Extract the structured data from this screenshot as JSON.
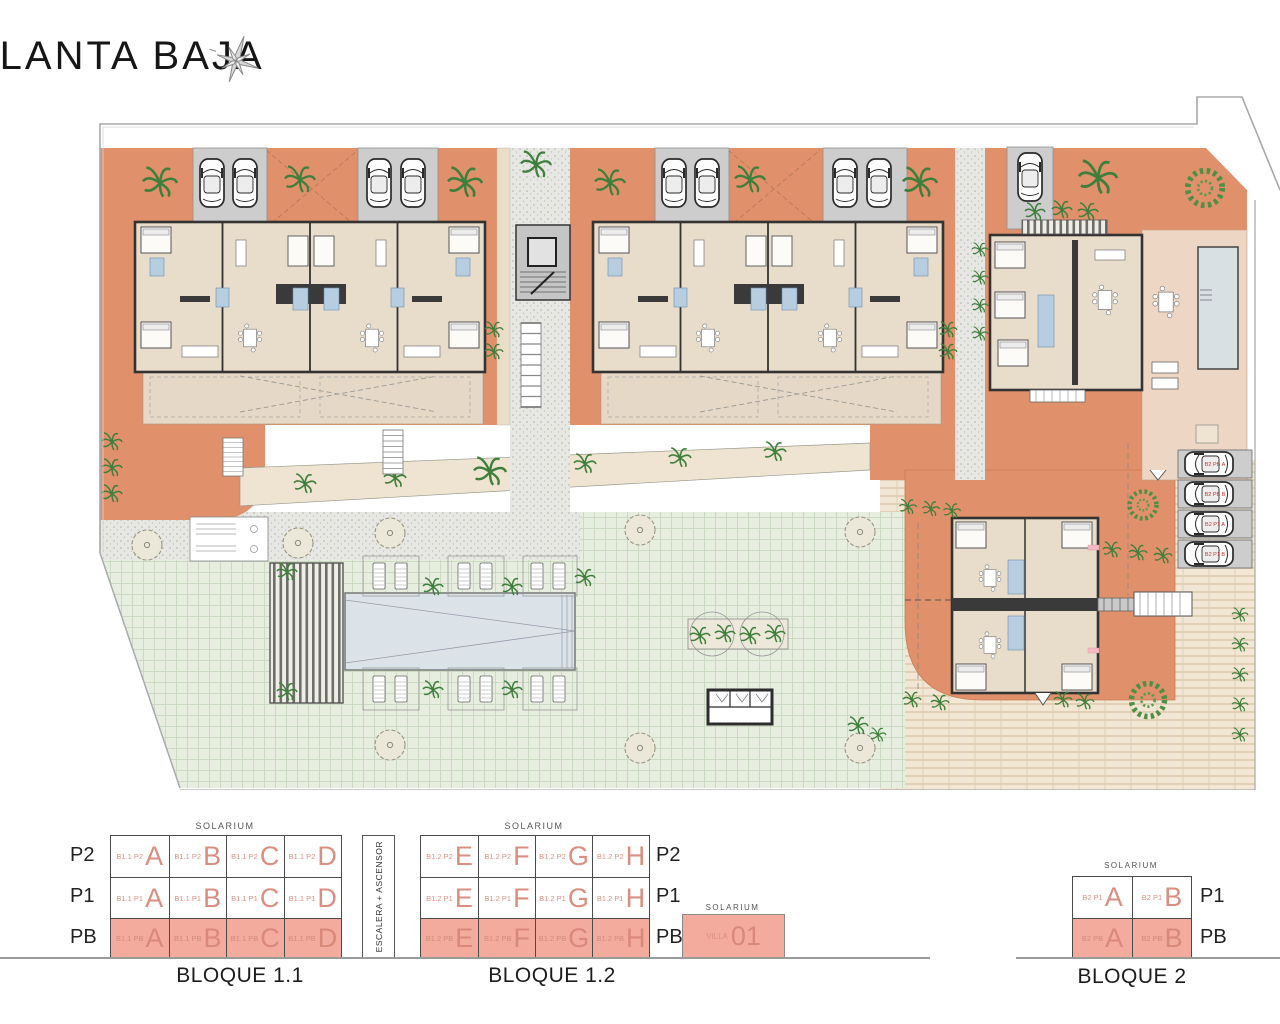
{
  "title": "PLANTA BAJA",
  "icons": {
    "compass": "compass-star-icon"
  },
  "colors": {
    "terracotta": "#e0906a",
    "salmon_highlight": "#f3ab9e",
    "unit_text": "#d98e80",
    "wall": "#3a3a3a"
  },
  "plan": {
    "parking_labels": [
      "B2 PB A",
      "B2 PB B",
      "B2 P1 A",
      "B2 P1 B"
    ]
  },
  "legend": {
    "solarium": "SOLARIUM",
    "stair": "ESCALERA + ASCENSOR",
    "b11": {
      "name": "BLOQUE 1.1",
      "floors": [
        "P2",
        "P1",
        "PB"
      ],
      "rows": [
        {
          "cells": [
            {
              "c": "B1.1 P2",
              "l": "A"
            },
            {
              "c": "B1.1 P2",
              "l": "B"
            },
            {
              "c": "B1.1 P2",
              "l": "C"
            },
            {
              "c": "B1.1 P2",
              "l": "D"
            }
          ]
        },
        {
          "cells": [
            {
              "c": "B1.1 P1",
              "l": "A"
            },
            {
              "c": "B1.1 P1",
              "l": "B"
            },
            {
              "c": "B1.1 P1",
              "l": "C"
            },
            {
              "c": "B1.1 P1",
              "l": "D"
            }
          ]
        },
        {
          "cells": [
            {
              "c": "B1.1 PB",
              "l": "A"
            },
            {
              "c": "B1.1 PB",
              "l": "B"
            },
            {
              "c": "B1.1 PB",
              "l": "C"
            },
            {
              "c": "B1.1 PB",
              "l": "D"
            }
          ]
        }
      ]
    },
    "b12": {
      "name": "BLOQUE 1.2",
      "floors": [
        "P2",
        "P1",
        "PB"
      ],
      "rows": [
        {
          "cells": [
            {
              "c": "B1.2 P2",
              "l": "E"
            },
            {
              "c": "B1.2 P2",
              "l": "F"
            },
            {
              "c": "B1.2 P2",
              "l": "G"
            },
            {
              "c": "B1.2 P2",
              "l": "H"
            }
          ]
        },
        {
          "cells": [
            {
              "c": "B1.2 P1",
              "l": "E"
            },
            {
              "c": "B1.2 P1",
              "l": "F"
            },
            {
              "c": "B1.2 P1",
              "l": "G"
            },
            {
              "c": "B1.2 P1",
              "l": "H"
            }
          ]
        },
        {
          "cells": [
            {
              "c": "B1.2 PB",
              "l": "E"
            },
            {
              "c": "B1.2 PB",
              "l": "F"
            },
            {
              "c": "B1.2 PB",
              "l": "G"
            },
            {
              "c": "B1.2 PB",
              "l": "H"
            }
          ]
        }
      ]
    },
    "villa": {
      "solarium": "SOLARIUM",
      "code": "VILLA",
      "number": "01"
    },
    "b2": {
      "name": "BLOQUE 2",
      "floors": [
        "P1",
        "PB"
      ],
      "rows": [
        {
          "cells": [
            {
              "c": "B2 P1",
              "l": "A"
            },
            {
              "c": "B2 P1",
              "l": "B"
            }
          ]
        },
        {
          "cells": [
            {
              "c": "B2 PB",
              "l": "A"
            },
            {
              "c": "B2 PB",
              "l": "B"
            }
          ]
        }
      ]
    }
  }
}
